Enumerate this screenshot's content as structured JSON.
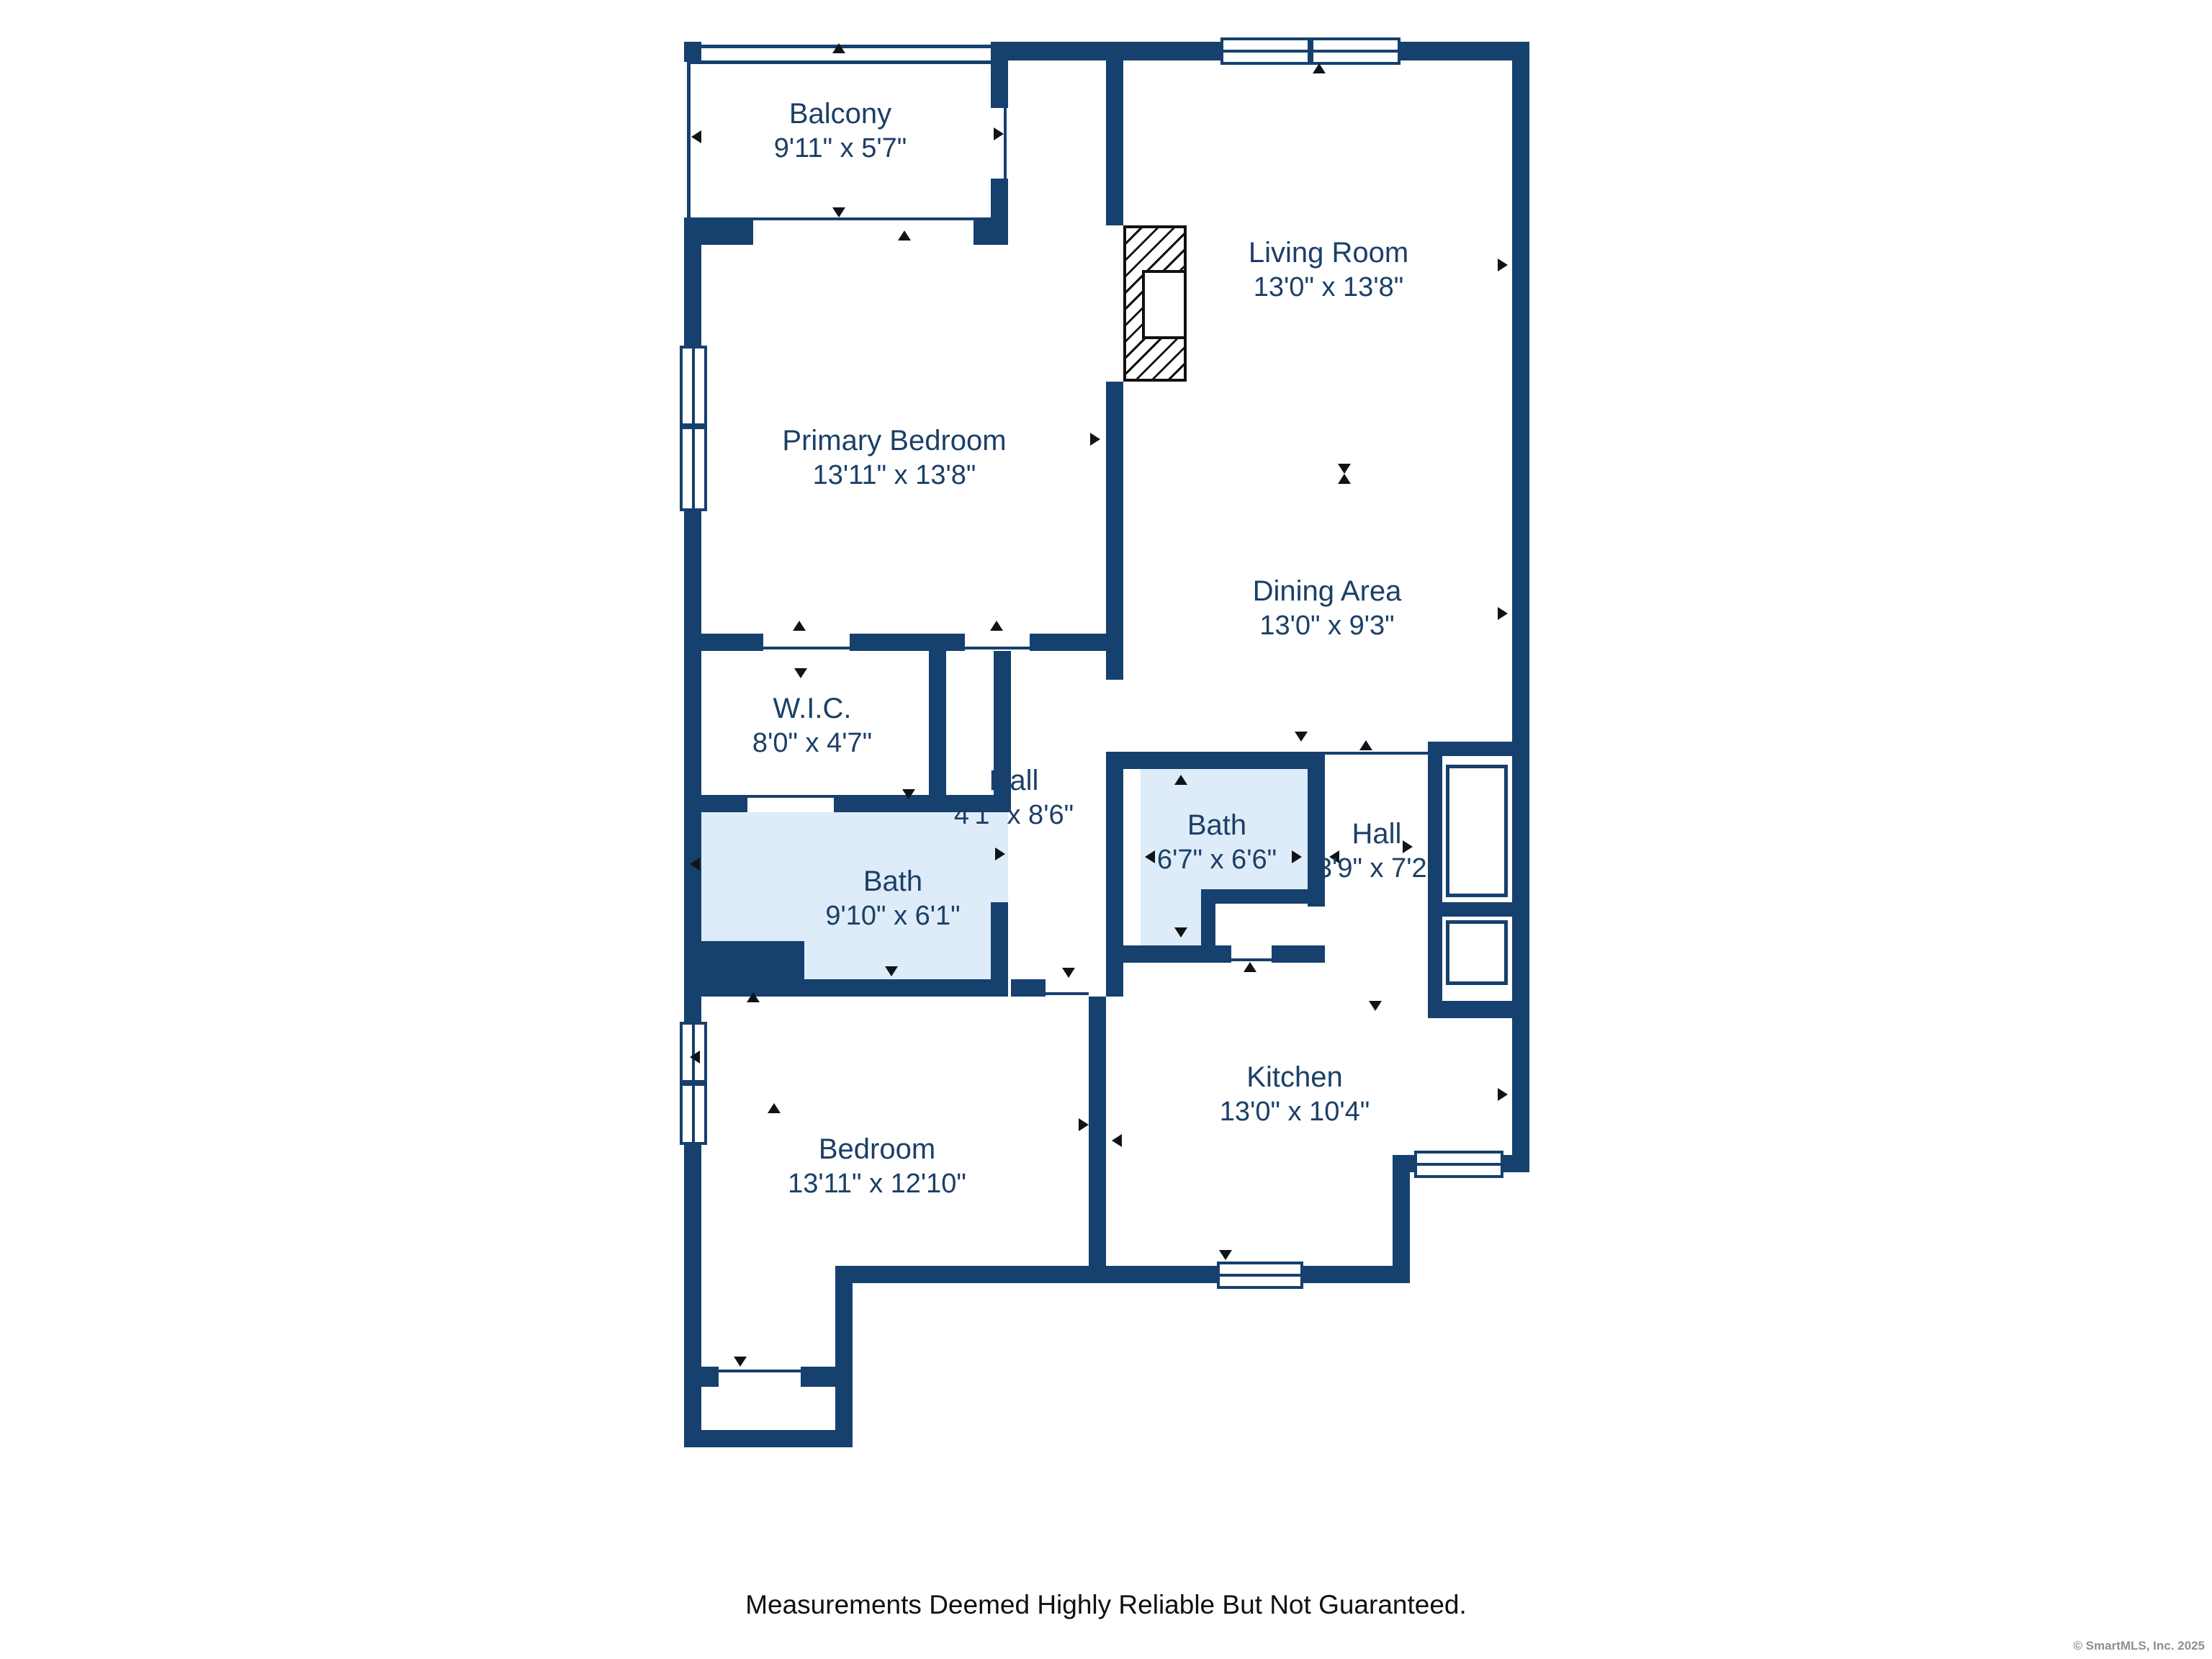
{
  "plan": {
    "rooms": {
      "balcony": {
        "name": "Balcony",
        "dims": "9'11\" x 5'7\""
      },
      "living_room": {
        "name": "Living Room",
        "dims": "13'0\" x 13'8\""
      },
      "primary_bedroom": {
        "name": "Primary Bedroom",
        "dims": "13'11\" x 13'8\""
      },
      "dining_area": {
        "name": "Dining Area",
        "dims": "13'0\" x 9'3\""
      },
      "wic": {
        "name": "W.I.C.",
        "dims": "8'0\" x 4'7\""
      },
      "hall_upper": {
        "name": "Hall",
        "dims": "4'1\" x 8'6\""
      },
      "bath_primary": {
        "name": "Bath",
        "dims": "9'10\" x 6'1\""
      },
      "bath_hall": {
        "name": "Bath",
        "dims": "6'7\" x 6'6\""
      },
      "hall_right": {
        "name": "Hall",
        "dims": "3'9\" x 7'2\""
      },
      "kitchen": {
        "name": "Kitchen",
        "dims": "13'0\" x 10'4\""
      },
      "bedroom": {
        "name": "Bedroom",
        "dims": "13'11\" x 12'10\""
      }
    },
    "colors": {
      "wall": "#16406e",
      "bath_fill": "#ddecf8",
      "label_text": "#1c3f67"
    }
  },
  "footer": {
    "disclaimer": "Measurements Deemed Highly Reliable But Not Guaranteed."
  },
  "watermark": {
    "copyright": "© SmartMLS, Inc.  2025"
  }
}
